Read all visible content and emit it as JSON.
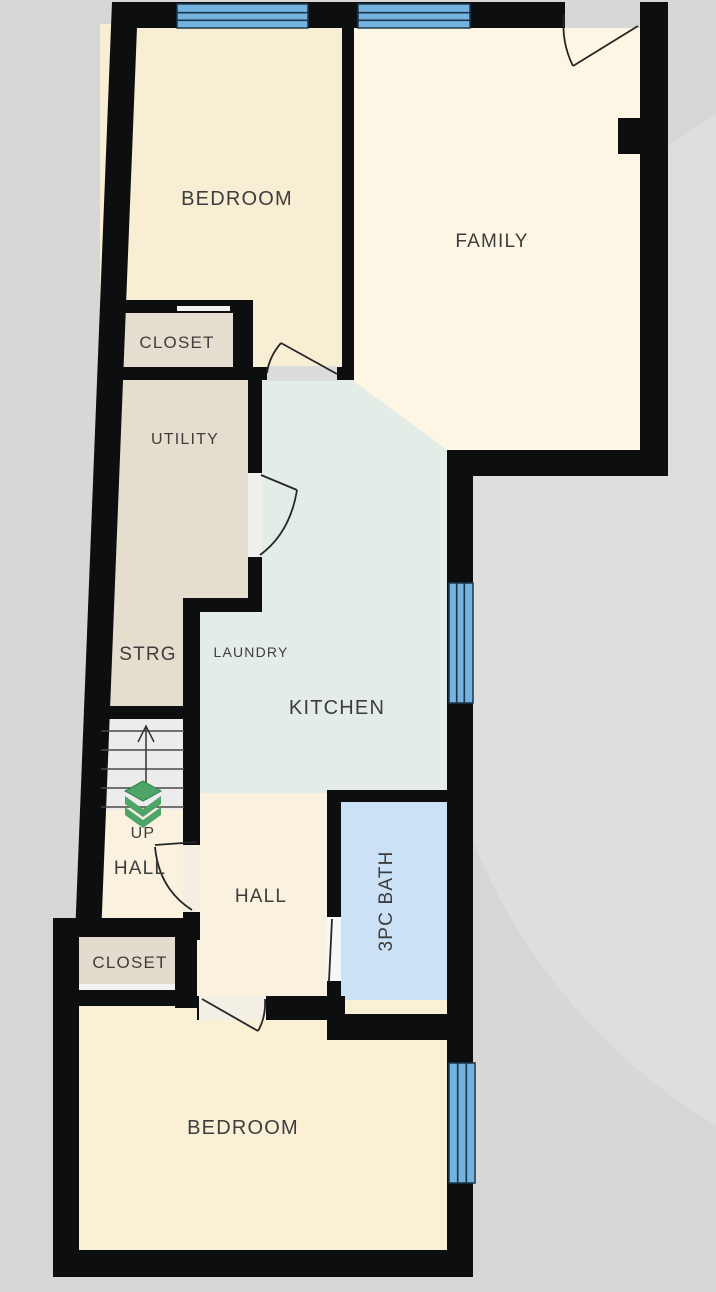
{
  "plan": {
    "type": "floor-plan",
    "colors": {
      "background": "#d7d7d7",
      "background_highlight": "#dedede",
      "wall": "#0d0e0f",
      "window_glass": "#74b2df",
      "window_frame": "#1c374b",
      "stairs_fill": "#ececec",
      "label_text": "#3d3d3d",
      "stairs_icon_green": "#4da567"
    },
    "stairs": {
      "label": "UP",
      "icon": "green-layers-up-arrow-icon"
    },
    "rooms": [
      {
        "id": "bedroom-top",
        "label": "BEDROOM",
        "color": "#f8eed3"
      },
      {
        "id": "family",
        "label": "FAMILY",
        "color": "#fdf6e5"
      },
      {
        "id": "closet-top",
        "label": "CLOSET",
        "color": "#e5ddd0"
      },
      {
        "id": "utility-strg",
        "label": "UTILITY",
        "color": "#e5decf"
      },
      {
        "id": "strg",
        "label": "STRG",
        "color": "#e5decf"
      },
      {
        "id": "laundry",
        "label": "LAUNDRY",
        "color": "#e3ece7"
      },
      {
        "id": "kitchen",
        "label": "KITCHEN",
        "color": "#e3ece7"
      },
      {
        "id": "hall-left",
        "label": "HALL",
        "color": "#faf2de"
      },
      {
        "id": "hall-center",
        "label": "HALL",
        "color": "#faf2de"
      },
      {
        "id": "bath",
        "label": "3PC BATH",
        "color": "#cbe1f5"
      },
      {
        "id": "closet-bottom",
        "label": "CLOSET",
        "color": "#e3dbcd"
      },
      {
        "id": "bedroom-bottom",
        "label": "BEDROOM",
        "color": "#faf0d6"
      }
    ],
    "window_count": 4,
    "door_count": 7
  }
}
